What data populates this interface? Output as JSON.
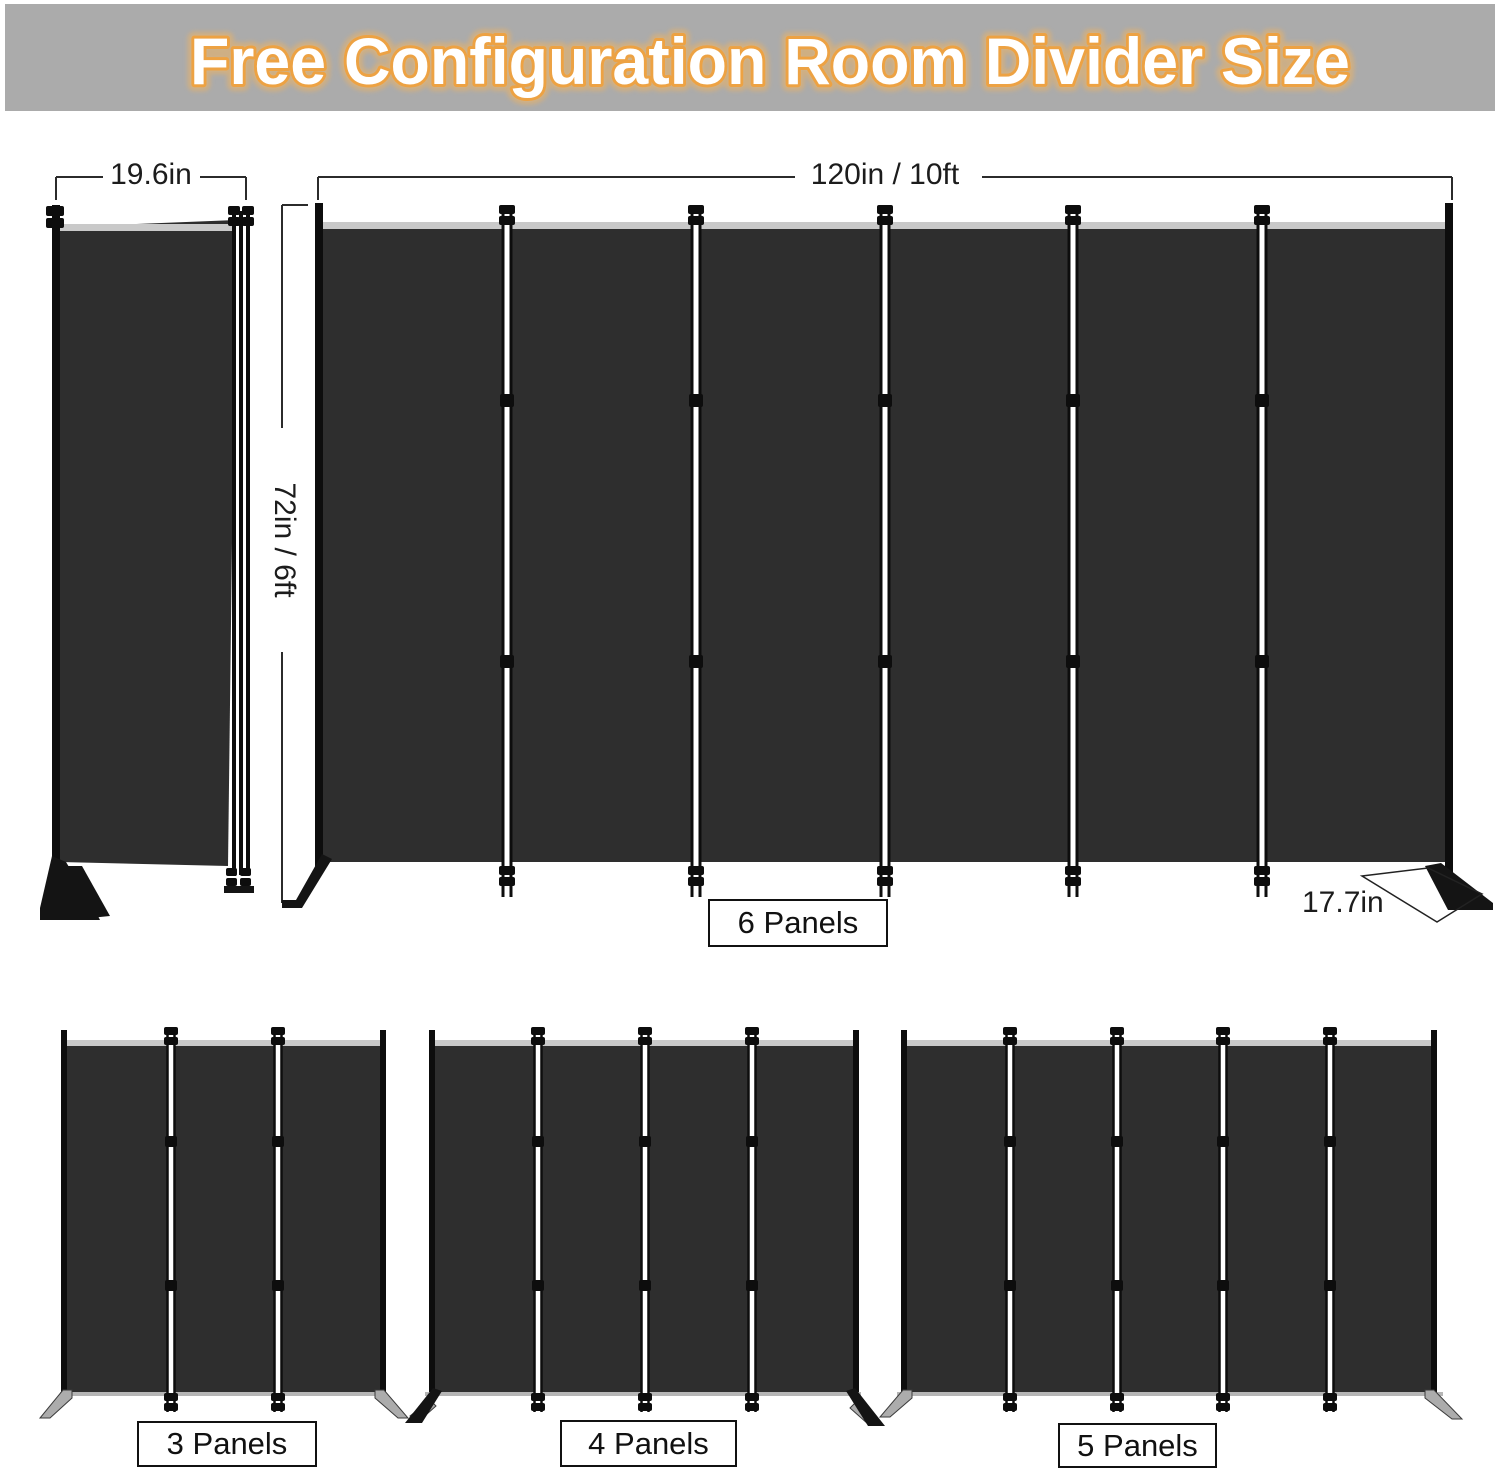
{
  "header": {
    "title": "Free Configuration Room Divider Size"
  },
  "dimensions": {
    "folded_width": "19.6in",
    "total_width": "120in / 10ft",
    "height": "72in / 6ft",
    "foot_depth": "17.7in"
  },
  "dividers": {
    "six_panel": {
      "label": "6 Panels"
    },
    "three_panel": {
      "label": "3 Panels"
    },
    "four_panel": {
      "label": "4 Panels"
    },
    "five_panel": {
      "label": "5 Panels"
    }
  },
  "colors": {
    "banner_background": "#ababab",
    "title_fill": "#ffffff",
    "title_outline": "#eda243",
    "panel_fabric": "#2e2e2e",
    "frame_black": "#0d0d0d",
    "top_rail": "#c9c9c9",
    "bottom_rail_silver": "#b5b5b5"
  }
}
